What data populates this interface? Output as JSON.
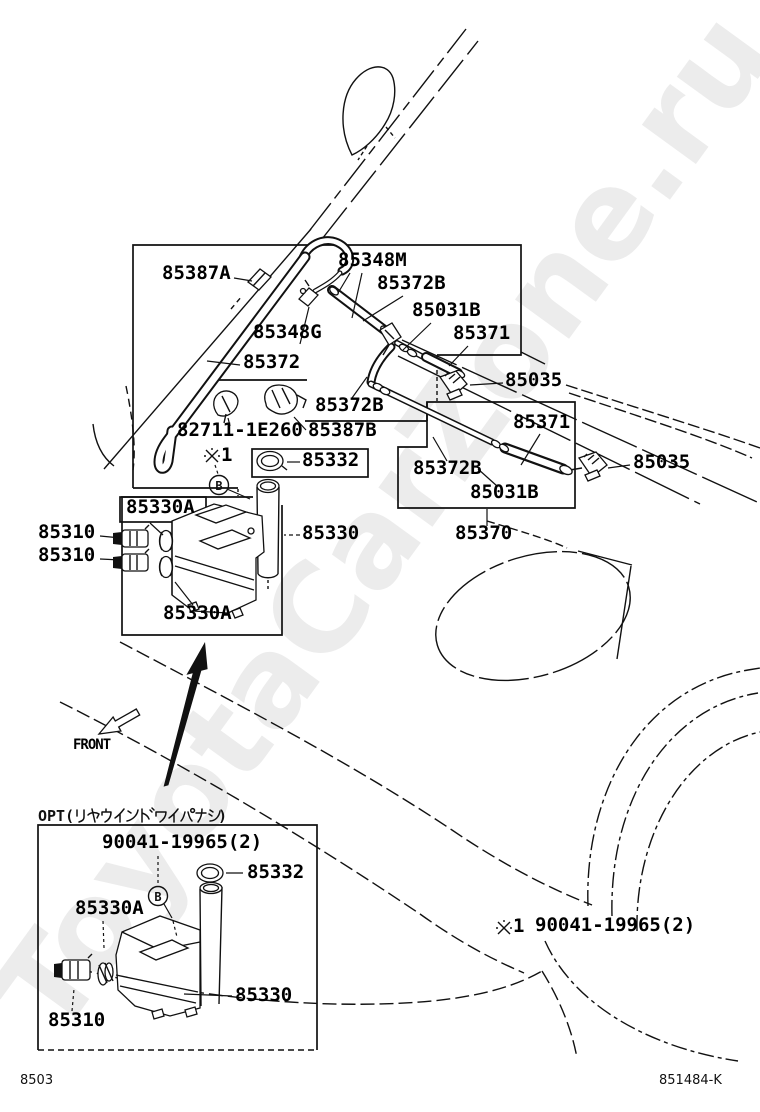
{
  "watermark": {
    "text": "ToyotaCarZone.ru",
    "color": "#ececec"
  },
  "footer": {
    "left_code": "8503",
    "right_code": "851484-K"
  },
  "front_marker": {
    "label": "FRONT",
    "arrow": "down-left"
  },
  "opt_section": {
    "header_full": "OPT(リヤウインドワイパナシ)",
    "header_prefix": "OPT(",
    "header_kana": "リヤウインドワイパナシ",
    "header_suffix": ")",
    "bolt_part_number": "90041-19965(2)"
  },
  "ref_notes": {
    "marker_glyph": "※",
    "main": {
      "id": "※1",
      "digit": "1"
    },
    "bottom": {
      "id": "※1",
      "digit": "1",
      "part_number": "90041-19965(2)"
    }
  },
  "detail_markers": [
    {
      "letter": "B",
      "section": "main"
    },
    {
      "letter": "B",
      "section": "opt"
    }
  ],
  "labels": [
    {
      "text": "85387A"
    },
    {
      "text": "85348M"
    },
    {
      "text": "85372B"
    },
    {
      "text": "85031B"
    },
    {
      "text": "85371"
    },
    {
      "text": "85348G"
    },
    {
      "text": "85372"
    },
    {
      "text": "85035"
    },
    {
      "text": "85372B"
    },
    {
      "text": "82711-1E260"
    },
    {
      "text": "85387B"
    },
    {
      "text": "85332"
    },
    {
      "text": "85330A"
    },
    {
      "text": "85310"
    },
    {
      "text": "85310"
    },
    {
      "text": "85330"
    },
    {
      "text": "85330A"
    },
    {
      "text": "85372B"
    },
    {
      "text": "85031B"
    },
    {
      "text": "85371"
    },
    {
      "text": "85035"
    },
    {
      "text": "85370"
    },
    {
      "text": "85332"
    },
    {
      "text": "85330A"
    },
    {
      "text": "85330"
    },
    {
      "text": "85310"
    }
  ]
}
